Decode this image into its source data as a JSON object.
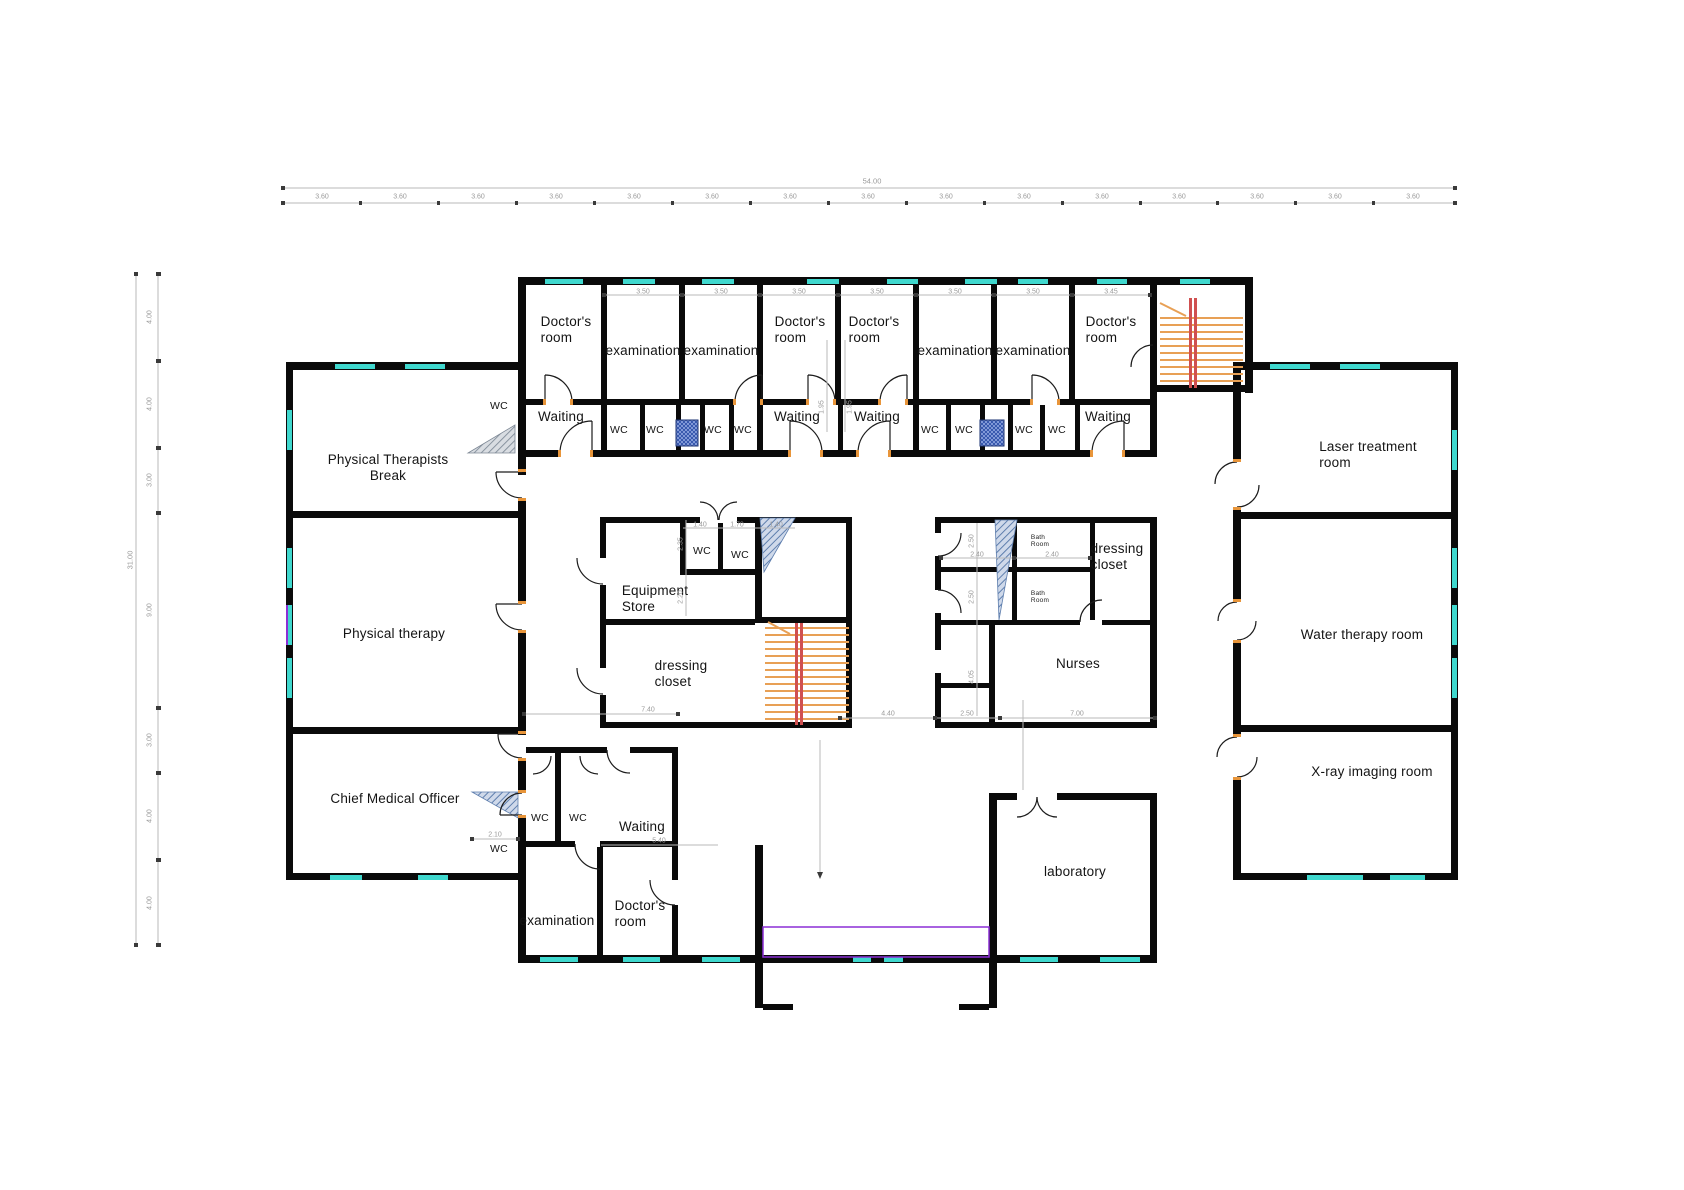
{
  "rooms": [
    {
      "id": "doctors-room-1",
      "label": "Doctor's\nroom"
    },
    {
      "id": "examination-1",
      "label": "examination"
    },
    {
      "id": "examination-2",
      "label": "examination"
    },
    {
      "id": "doctors-room-2",
      "label": "Doctor's\nroom"
    },
    {
      "id": "doctors-room-3",
      "label": "Doctor's\nroom"
    },
    {
      "id": "examination-3",
      "label": "examination"
    },
    {
      "id": "examination-4",
      "label": "examination"
    },
    {
      "id": "doctors-room-4",
      "label": "Doctor's\nroom"
    },
    {
      "id": "waiting-1",
      "label": "Waiting"
    },
    {
      "id": "waiting-2",
      "label": "Waiting"
    },
    {
      "id": "waiting-3",
      "label": "Waiting"
    },
    {
      "id": "waiting-4",
      "label": "Waiting"
    },
    {
      "id": "physical-therapists-break",
      "label": "Physical Therapists\nBreak"
    },
    {
      "id": "physical-therapy",
      "label": "Physical therapy"
    },
    {
      "id": "chief-medical-officer",
      "label": "Chief Medical Officer"
    },
    {
      "id": "laser-treatment-room",
      "label": "Laser treatment\nroom"
    },
    {
      "id": "water-therapy-room",
      "label": "Water therapy room"
    },
    {
      "id": "xray-imaging-room",
      "label": "X-ray imaging room"
    },
    {
      "id": "equipment-store",
      "label": "Equipment\nStore"
    },
    {
      "id": "dressing-closet-1",
      "label": "dressing\ncloset"
    },
    {
      "id": "dressing-closet-2",
      "label": "dressing\ncloset"
    },
    {
      "id": "nurses",
      "label": "Nurses"
    },
    {
      "id": "laboratory",
      "label": "laboratory"
    },
    {
      "id": "waiting-5",
      "label": "Waiting"
    },
    {
      "id": "examination-5",
      "label": "examination"
    },
    {
      "id": "doctors-room-5",
      "label": "Doctor's\nroom"
    },
    {
      "id": "bath-room-1",
      "label": "Bath\nRoom"
    },
    {
      "id": "bath-room-2",
      "label": "Bath\nRoom"
    }
  ],
  "wc_labels": [
    "WC",
    "WC",
    "WC",
    "WC",
    "WC",
    "WC",
    "WC",
    "WC",
    "WC",
    "WC",
    "WC",
    "WC",
    "WC",
    "WC"
  ],
  "dims": {
    "top_total": "54.00",
    "top_segments": [
      "3.60",
      "3.60",
      "3.60",
      "3.60",
      "3.60",
      "3.60",
      "3.60",
      "3.60",
      "3.60",
      "3.60",
      "3.60",
      "3.60",
      "3.60",
      "3.60",
      "3.60"
    ],
    "left_total": "31.00",
    "left_segments": [
      "4.00",
      "4.00",
      "3.00",
      "9.00",
      "3.00",
      "4.00",
      "4.00"
    ],
    "room_widths": [
      "3.50",
      "3.50",
      "3.50",
      "3.50",
      "3.50",
      "3.50",
      "3.45"
    ],
    "wc_top": [
      "1.40",
      "1.70",
      "1.40"
    ],
    "bath": [
      "2.40",
      "2.40"
    ],
    "hall": [
      "7.40",
      "4.40",
      "2.50",
      "7.00"
    ],
    "bottom": [
      "2.10",
      "5.40"
    ],
    "vertical": [
      "1.95",
      "1.95",
      "2.35",
      "2.20",
      "2.50",
      "2.50",
      "4.05"
    ]
  },
  "colors": {
    "wall": "#0a0a0a",
    "window": "#3fd8ce",
    "stair_tread": "#e8a055",
    "stair_rail": "#d05050",
    "door_jamb": "#e8953a",
    "vestibule_outline": "#8b2fd6",
    "ramp_hatch_blue": "#5f7fae",
    "ramp_hatch_gray": "#8a94a0",
    "fixture_navy": "#2b4da6",
    "dimension_line": "#b9b9b9"
  }
}
